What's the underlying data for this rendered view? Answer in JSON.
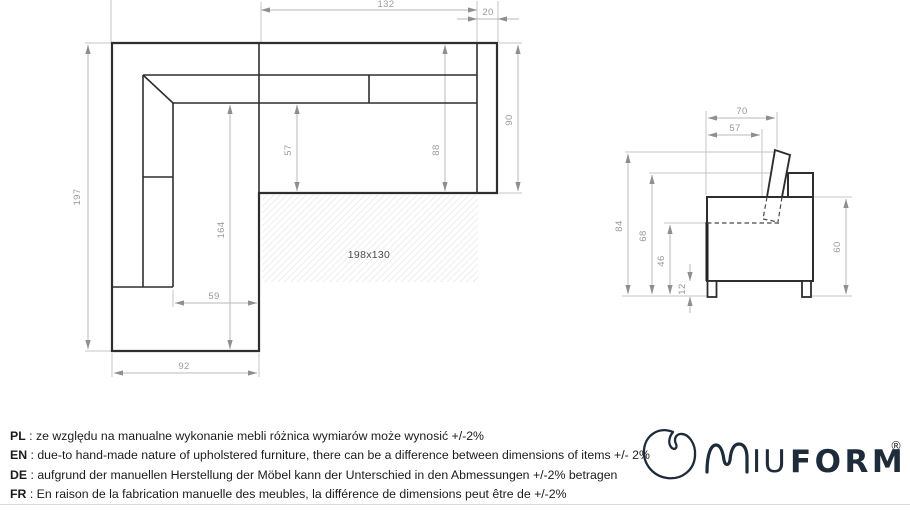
{
  "drawing": {
    "top_view": {
      "bed_area_label": "198x130",
      "dims": {
        "seat_width": "132",
        "armrest_width": "20",
        "total_depth": "197",
        "seat_depth": "57",
        "back_span": "88",
        "right_side_depth": "90",
        "chaise_length": "164",
        "chaise_seat_width": "59",
        "chaise_total_width": "92"
      }
    },
    "side_view": {
      "dims": {
        "depth_to_headrest": "70",
        "seat_depth": "57",
        "total_height": "84",
        "backrest_height": "68",
        "seat_height": "46",
        "leg_height": "12",
        "body_height": "60"
      }
    }
  },
  "footer": {
    "separator": " : ",
    "notes": [
      {
        "lang": "PL",
        "text": "ze względu na manualne wykonanie mebli różnica wymiarów może wynosić +/-2%"
      },
      {
        "lang": "EN",
        "text": "due-to hand-made nature of upholstered furniture, there can be a difference between dimensions of items +/- 2%"
      },
      {
        "lang": "DE",
        "text": "aufgrund der manuellen Herstellung der Möbel kann der Unterschied in den Abmessungen +/-2% betragen"
      },
      {
        "lang": "FR",
        "text": "En raison de la fabrication manuelle des meubles, la différence de dimensions peut être de +/-2%"
      }
    ]
  },
  "logo": {
    "iu": "IU",
    "form": "FORM",
    "registered": "®"
  },
  "colors": {
    "outline": "#2e2e2e",
    "dimension": "#b8b8b8",
    "dimension_text": "#9a9a9a",
    "hatch": "#dcdcdc",
    "logo_navy": "#1e2b3a"
  }
}
